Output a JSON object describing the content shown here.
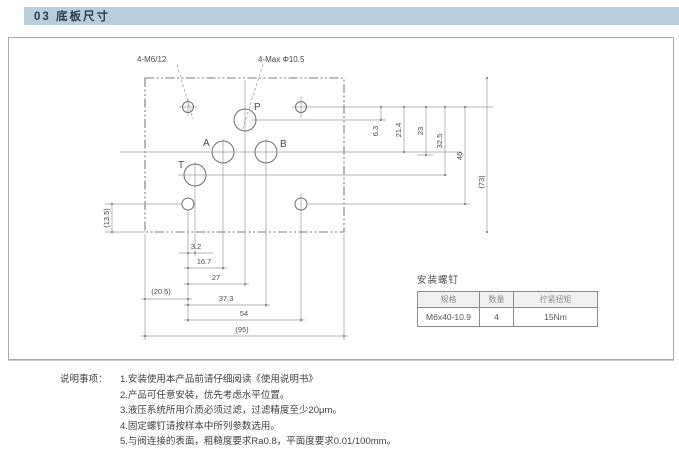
{
  "page": {
    "header": {
      "title": "03 底板尺寸"
    }
  },
  "drawing": {
    "annotations": {
      "thread_holes": "4-M6/12",
      "max_port": "4-Max Φ10.5"
    },
    "port_labels": {
      "p": "P",
      "a": "A",
      "b": "B",
      "t": "T"
    },
    "dims": {
      "h_3_2": "3.2",
      "h_16_7": "16.7",
      "h_27": "27",
      "h_20_5": "(20.5)",
      "h_37_3": "37.3",
      "h_54": "54",
      "h_95": "(95)",
      "v_6_3": "6.3",
      "v_21_4": "21.4",
      "v_23": "23",
      "v_32_5": "32.5",
      "v_46": "46",
      "v_73": "(73)",
      "left_13_5": "(13.5)"
    }
  },
  "screw_table": {
    "title": "安装螺钉",
    "headers": [
      "规格",
      "数量",
      "拧紧扭矩"
    ],
    "row": [
      "M6x40-10.9",
      "4",
      "15Nm"
    ]
  },
  "notes": {
    "label": "说明事项：",
    "items": [
      "1.安装使用本产品前请仔细阅读《使用说明书》",
      "2.产品可任意安装，优先考虑水平位置。",
      "3.液压系统所用介质必须过滤，过滤精度至少20μm。",
      "4.固定螺钉请按样本中所列参数选用。",
      "5.与阀连接的表面，粗糙度要求Ra0.8，平面度要求0.01/100mm。"
    ]
  },
  "colors": {
    "header_bg": "#b9cedb",
    "header_text": "#2b3b4e",
    "frame_border": "#a9a9a9",
    "line": "#8a8a8a"
  }
}
